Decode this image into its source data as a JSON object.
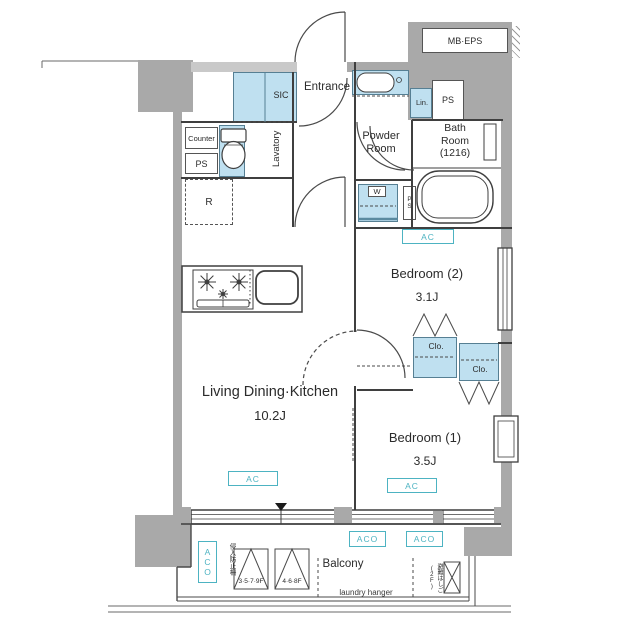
{
  "unit": {
    "rooms": {
      "entrance": "Entrance",
      "sic": "SIC",
      "lavatory": "Lavatory",
      "counter": "Counter",
      "ps_lavatory": "PS",
      "powder_room": "Powder\nRoom",
      "bath_room": "Bath\nRoom\n(1216)",
      "linen": "Lin.",
      "ps_meter": "PS",
      "mb_eps": "MB·EPS",
      "washer": "W",
      "ps_pipe": "PS",
      "refrigerator": "R",
      "bedroom2": {
        "name": "Bedroom (2)",
        "size": "3.1J"
      },
      "bedroom1": {
        "name": "Bedroom (1)",
        "size": "3.5J"
      },
      "ldk": {
        "name": "Living Dining·Kitchen",
        "size": "10.2J"
      },
      "closet": "Clo.",
      "balcony": "Balcony"
    },
    "equipment": {
      "ac": "AC",
      "aco": "ACO"
    },
    "notes": {
      "laundry_hanger": "laundry hanger",
      "floor_panel_a": "3·5·7·9F",
      "floor_panel_b": "4·6·8F",
      "intrusion_fence": "侵入防止柵",
      "escape_ladder": "避難はしご(2F)",
      "direction_marker": "▼"
    },
    "colors": {
      "fixture_blue": "#bfe0f0",
      "accent_teal": "#4db3c2",
      "wall_gray": "#a9a9a9",
      "line": "#3f3f3f"
    }
  }
}
